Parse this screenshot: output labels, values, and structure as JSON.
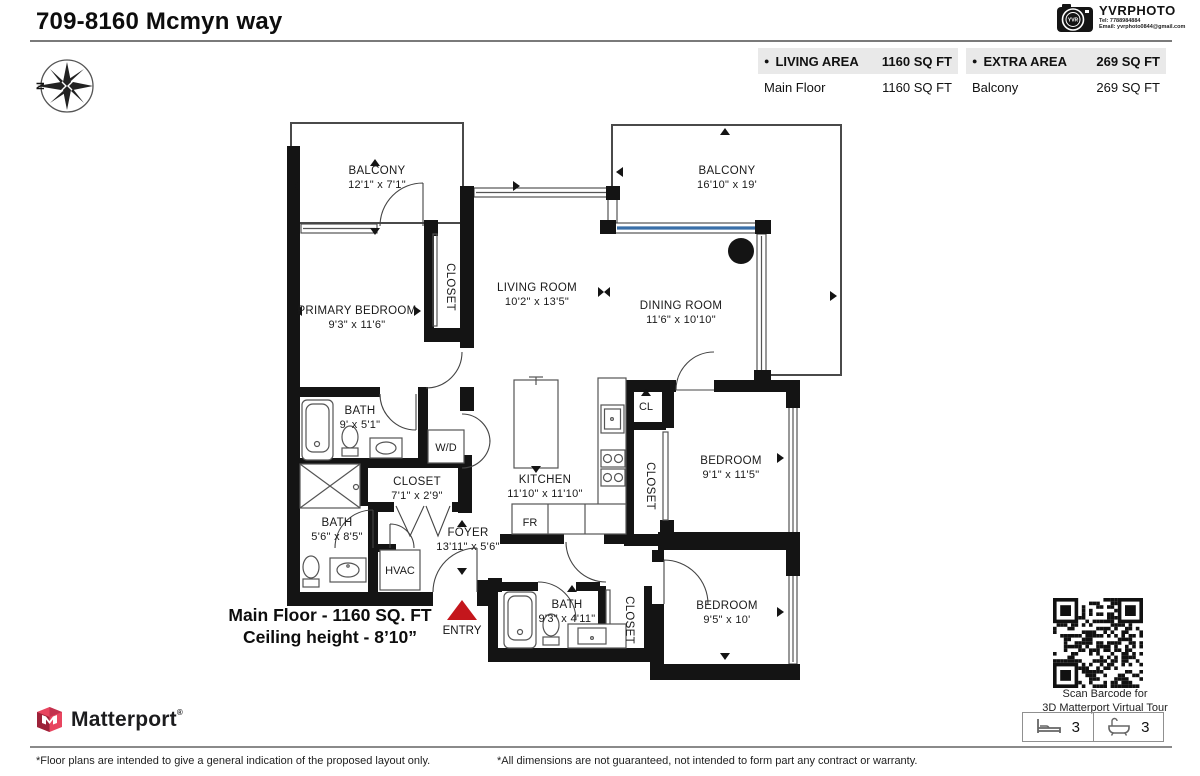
{
  "page": {
    "title": "709-8160 Mcmyn way"
  },
  "vendor": {
    "name": "YVRPHOTO",
    "lens": "YVR",
    "tel": "Tel:  7788984884",
    "email": "Email:  yvrphoto0844@gmail.com"
  },
  "compass": {
    "north": "N"
  },
  "area_summary": {
    "living": {
      "bullet": "●",
      "label": "LIVING AREA",
      "total": "1160 SQ FT",
      "rows": [
        {
          "label": "Main Floor",
          "value": "1160 SQ FT"
        }
      ]
    },
    "extra": {
      "bullet": "●",
      "label": "EXTRA AREA",
      "total": "269 SQ FT",
      "rows": [
        {
          "label": "Balcony",
          "value": "269 SQ FT"
        }
      ]
    }
  },
  "plan": {
    "rooms": [
      {
        "id": "balcony-tl",
        "name": "BALCONY",
        "dims": "12'1\" x 7'1\""
      },
      {
        "id": "balcony-tr",
        "name": "BALCONY",
        "dims": "16'10\" x 19'"
      },
      {
        "id": "primary-bedroom",
        "name": "PRIMARY BEDROOM",
        "dims": "9'3\" x 11'6\""
      },
      {
        "id": "closet-primary",
        "name": "CLOSET",
        "dims": ""
      },
      {
        "id": "living-room",
        "name": "LIVING ROOM",
        "dims": "10'2\" x 13'5\""
      },
      {
        "id": "dining-room",
        "name": "DINING ROOM",
        "dims": "11'6\" x 10'10\""
      },
      {
        "id": "bath-1",
        "name": "BATH",
        "dims": "9' x 5'1\""
      },
      {
        "id": "washer-dryer",
        "name": "W/D",
        "dims": ""
      },
      {
        "id": "closet-hall",
        "name": "CLOSET",
        "dims": "7'1\" x 2'9\""
      },
      {
        "id": "bath-2",
        "name": "BATH",
        "dims": "5'6\" x 8'5\""
      },
      {
        "id": "hvac",
        "name": "HVAC",
        "dims": ""
      },
      {
        "id": "foyer",
        "name": "FOYER",
        "dims": "13'11\" x 5'6\""
      },
      {
        "id": "kitchen",
        "name": "KITCHEN",
        "dims": "11'10\" x 11'10\""
      },
      {
        "id": "fridge",
        "name": "FR",
        "dims": ""
      },
      {
        "id": "cl",
        "name": "CL",
        "dims": ""
      },
      {
        "id": "closet-kitchen",
        "name": "CLOSET",
        "dims": ""
      },
      {
        "id": "bedroom-1",
        "name": "BEDROOM",
        "dims": "9'1\" x 11'5\""
      },
      {
        "id": "bedroom-2",
        "name": "BEDROOM",
        "dims": "9'5\" x 10'"
      },
      {
        "id": "bath-3",
        "name": "BATH",
        "dims": "9'3\" x 4'11\""
      },
      {
        "id": "closet-bath3",
        "name": "CLOSET",
        "dims": ""
      }
    ],
    "entry_label": "ENTRY",
    "floor_note_line1": "Main Floor - 1160 SQ. FT",
    "floor_note_line2": "Ceiling height - 8’10”"
  },
  "qr": {
    "caption_line1": "Scan Barcode for",
    "caption_line2": "3D Matterport Virtual Tour"
  },
  "branding": {
    "matterport": "Matterport",
    "registered": "®"
  },
  "stats": {
    "beds": "3",
    "baths": "3"
  },
  "footer": {
    "left_note": "*Floor plans are intended to give a general indication of the proposed layout only.",
    "right_note": "*All dimensions are not guaranteed, not intended to form part any contract or warranty."
  }
}
